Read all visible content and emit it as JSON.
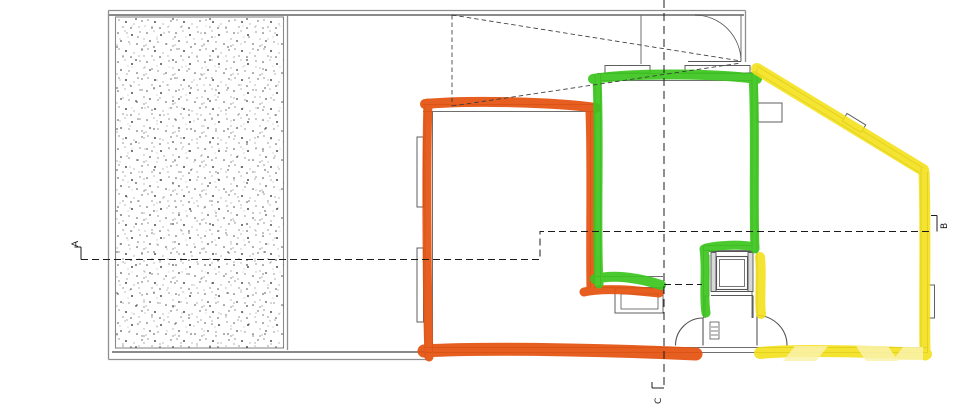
{
  "section_labels": {
    "a": "A",
    "b": "B",
    "c": "C"
  },
  "colors": {
    "highlight_orange": "#e4520f",
    "highlight_green": "#3cc61f",
    "highlight_yellow": "#f4e016",
    "watermark_yellow": "#faf3ab"
  }
}
